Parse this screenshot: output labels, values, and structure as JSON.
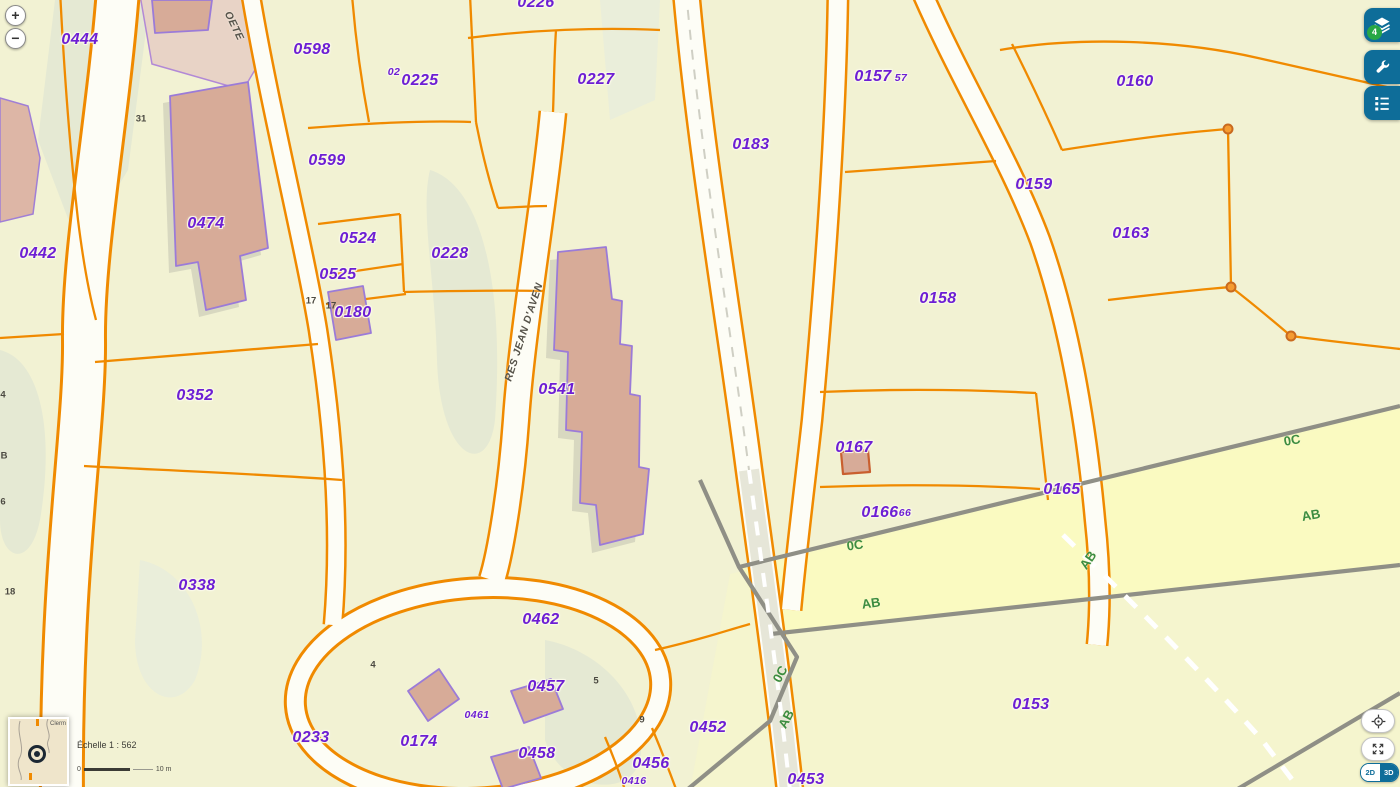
{
  "controls": {
    "zoom_in": "+",
    "zoom_out": "−",
    "layers_badge": "4",
    "view_toggle": {
      "d2": "2D",
      "d3": "3D"
    },
    "scale": {
      "echelle": "Échelle 1 : 562",
      "zero": "0",
      "max": "10 m"
    },
    "overview": {
      "place": "Clerm"
    }
  },
  "map": {
    "colors": {
      "background": "#f2f2d3",
      "parcel_line": "#f08a00",
      "road_fill": "#fdfdf6",
      "building_fill": "#d7ab98",
      "building_stroke": "#9b7bd8",
      "parcel_label": "#6d1ed4",
      "section_label": "#3c8c40",
      "boundary_gray": "#8f8f86",
      "button_blue": "#0e6d99",
      "badge_green": "#28a745"
    },
    "labels": {
      "parcels": [
        {
          "t": "0444",
          "x": 80,
          "y": 40
        },
        {
          "t": "0598",
          "x": 312,
          "y": 50
        },
        {
          "t": "0225",
          "x": 420,
          "y": 81
        },
        {
          "t": "0226",
          "x": 536,
          "y": 3
        },
        {
          "t": "0227",
          "x": 596,
          "y": 80
        },
        {
          "t": "0157",
          "x": 873,
          "y": 77
        },
        {
          "t": "0160",
          "x": 1135,
          "y": 82
        },
        {
          "t": "0599",
          "x": 327,
          "y": 161
        },
        {
          "t": "0183",
          "x": 751,
          "y": 145
        },
        {
          "t": "0159",
          "x": 1034,
          "y": 185
        },
        {
          "t": "0474",
          "x": 206,
          "y": 224
        },
        {
          "t": "0524",
          "x": 358,
          "y": 239
        },
        {
          "t": "0163",
          "x": 1131,
          "y": 234
        },
        {
          "t": "0442",
          "x": 38,
          "y": 254
        },
        {
          "t": "0525",
          "x": 338,
          "y": 275
        },
        {
          "t": "0158",
          "x": 938,
          "y": 299
        },
        {
          "t": "0180",
          "x": 353,
          "y": 313
        },
        {
          "t": "0228",
          "x": 450,
          "y": 254
        },
        {
          "t": "0352",
          "x": 195,
          "y": 396
        },
        {
          "t": "0541",
          "x": 557,
          "y": 390
        },
        {
          "t": "0167",
          "x": 854,
          "y": 448
        },
        {
          "t": "0165",
          "x": 1062,
          "y": 490
        },
        {
          "t": "0166",
          "x": 880,
          "y": 513
        },
        {
          "t": "0338",
          "x": 197,
          "y": 586
        },
        {
          "t": "0462",
          "x": 541,
          "y": 620
        },
        {
          "t": "0457",
          "x": 546,
          "y": 687
        },
        {
          "t": "0452",
          "x": 708,
          "y": 728
        },
        {
          "t": "0233",
          "x": 311,
          "y": 738
        },
        {
          "t": "0174",
          "x": 419,
          "y": 742
        },
        {
          "t": "0153",
          "x": 1031,
          "y": 705
        },
        {
          "t": "0458",
          "x": 537,
          "y": 754
        },
        {
          "t": "0456",
          "x": 651,
          "y": 764
        },
        {
          "t": "0453",
          "x": 806,
          "y": 780
        }
      ],
      "small_parcels": [
        {
          "t": "02",
          "x": 394,
          "y": 72
        },
        {
          "t": "57",
          "x": 901,
          "y": 78
        },
        {
          "t": "66",
          "x": 905,
          "y": 513
        },
        {
          "t": "0461",
          "x": 477,
          "y": 715
        },
        {
          "t": "0416",
          "x": 634,
          "y": 781
        }
      ],
      "house_numbers": [
        {
          "t": "31",
          "x": 141,
          "y": 119
        },
        {
          "t": "17",
          "x": 311,
          "y": 301
        },
        {
          "t": "17",
          "x": 331,
          "y": 306
        },
        {
          "t": "4",
          "x": 373,
          "y": 665
        },
        {
          "t": "4",
          "x": 3,
          "y": 395
        },
        {
          "t": "B",
          "x": 4,
          "y": 456
        },
        {
          "t": "6",
          "x": 3,
          "y": 502
        },
        {
          "t": "18",
          "x": 10,
          "y": 592
        },
        {
          "t": "5",
          "x": 596,
          "y": 681
        },
        {
          "t": "9",
          "x": 642,
          "y": 720
        }
      ],
      "sections": [
        {
          "t": "0C",
          "x": 855,
          "y": 545,
          "r": -8
        },
        {
          "t": "AB",
          "x": 871,
          "y": 603,
          "r": -8
        },
        {
          "t": "0C",
          "x": 1292,
          "y": 440,
          "r": -10
        },
        {
          "t": "AB",
          "x": 1311,
          "y": 515,
          "r": -10
        },
        {
          "t": "AB",
          "x": 1088,
          "y": 560,
          "r": -55
        },
        {
          "t": "0C",
          "x": 780,
          "y": 674,
          "r": -62
        },
        {
          "t": "AB",
          "x": 786,
          "y": 719,
          "r": -62
        }
      ],
      "streets": [
        {
          "t": "OETE",
          "x": 234,
          "y": 26,
          "r": 64
        },
        {
          "t": "RES JEAN D'AVEN",
          "x": 524,
          "y": 332,
          "r": -72
        }
      ]
    }
  }
}
